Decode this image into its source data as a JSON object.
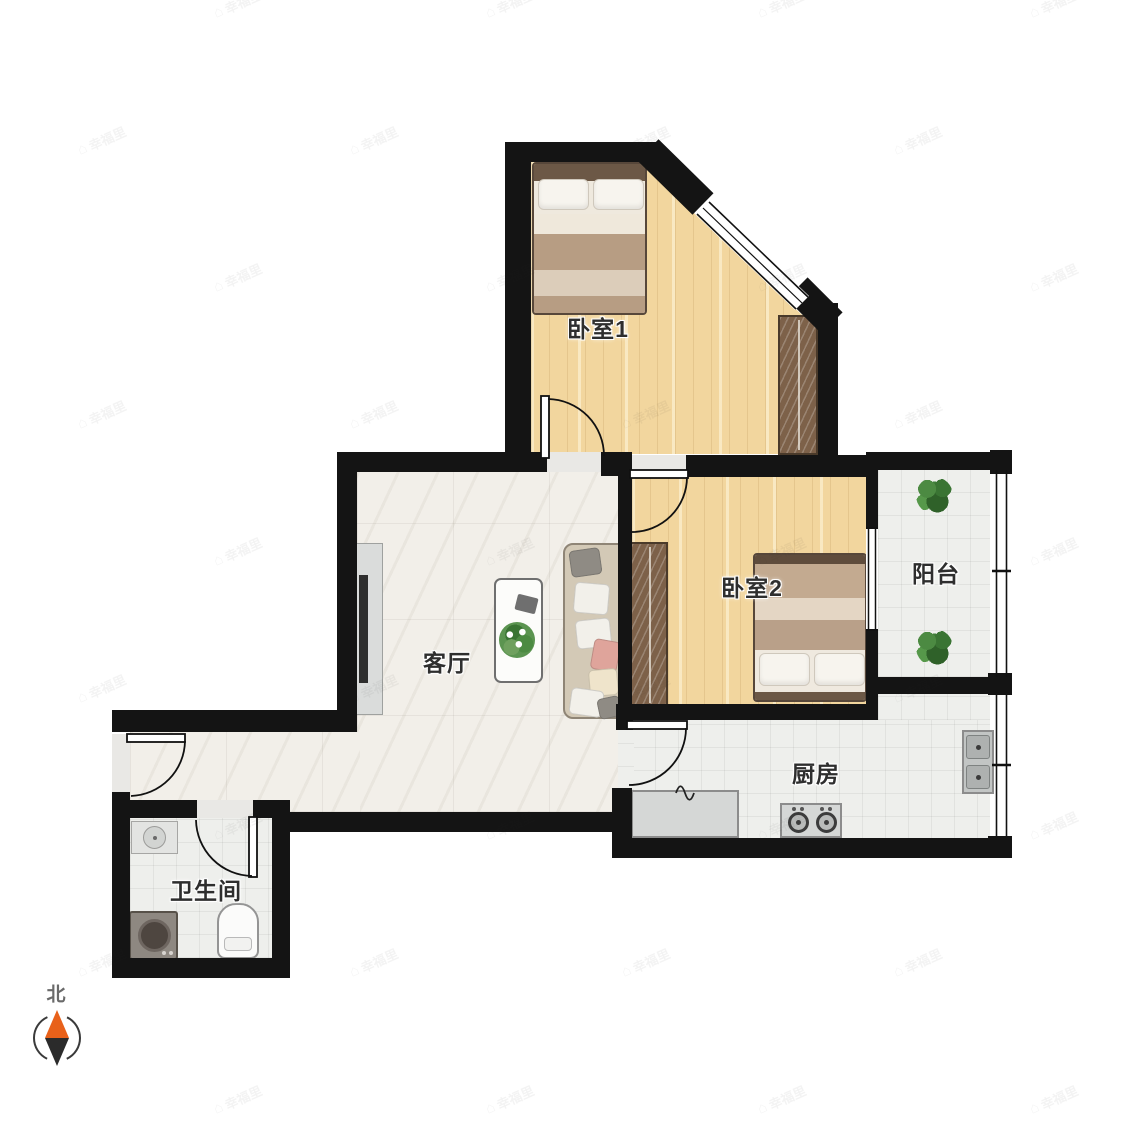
{
  "plan": {
    "rooms": [
      {
        "id": "bedroom1",
        "label": "卧室1"
      },
      {
        "id": "bedroom2",
        "label": "卧室2"
      },
      {
        "id": "living-room",
        "label": "客厅"
      },
      {
        "id": "balcony",
        "label": "阳台"
      },
      {
        "id": "kitchen",
        "label": "厨房"
      },
      {
        "id": "bathroom",
        "label": "卫生间"
      }
    ],
    "compass": {
      "label": "北",
      "north_color": "#E8611A",
      "south_color": "#2B2B2B"
    },
    "watermark": {
      "text": "幸福里",
      "icon": "house-icon"
    },
    "furniture": [
      "double-bed",
      "wardrobe",
      "sofa",
      "coffee-table",
      "tv-stand",
      "plant",
      "kitchen-counter",
      "stove",
      "kitchen-sink",
      "washing-machine",
      "toilet",
      "bathroom-sink"
    ],
    "colors": {
      "wall": "#141414",
      "wood_floor": "#F2D69E",
      "marble_floor": "#F2EFE9",
      "tile_floor": "#EEEFEC",
      "wardrobe": "#7D6149",
      "sofa": "#D3C9B6",
      "compass_north": "#E8611A"
    }
  }
}
